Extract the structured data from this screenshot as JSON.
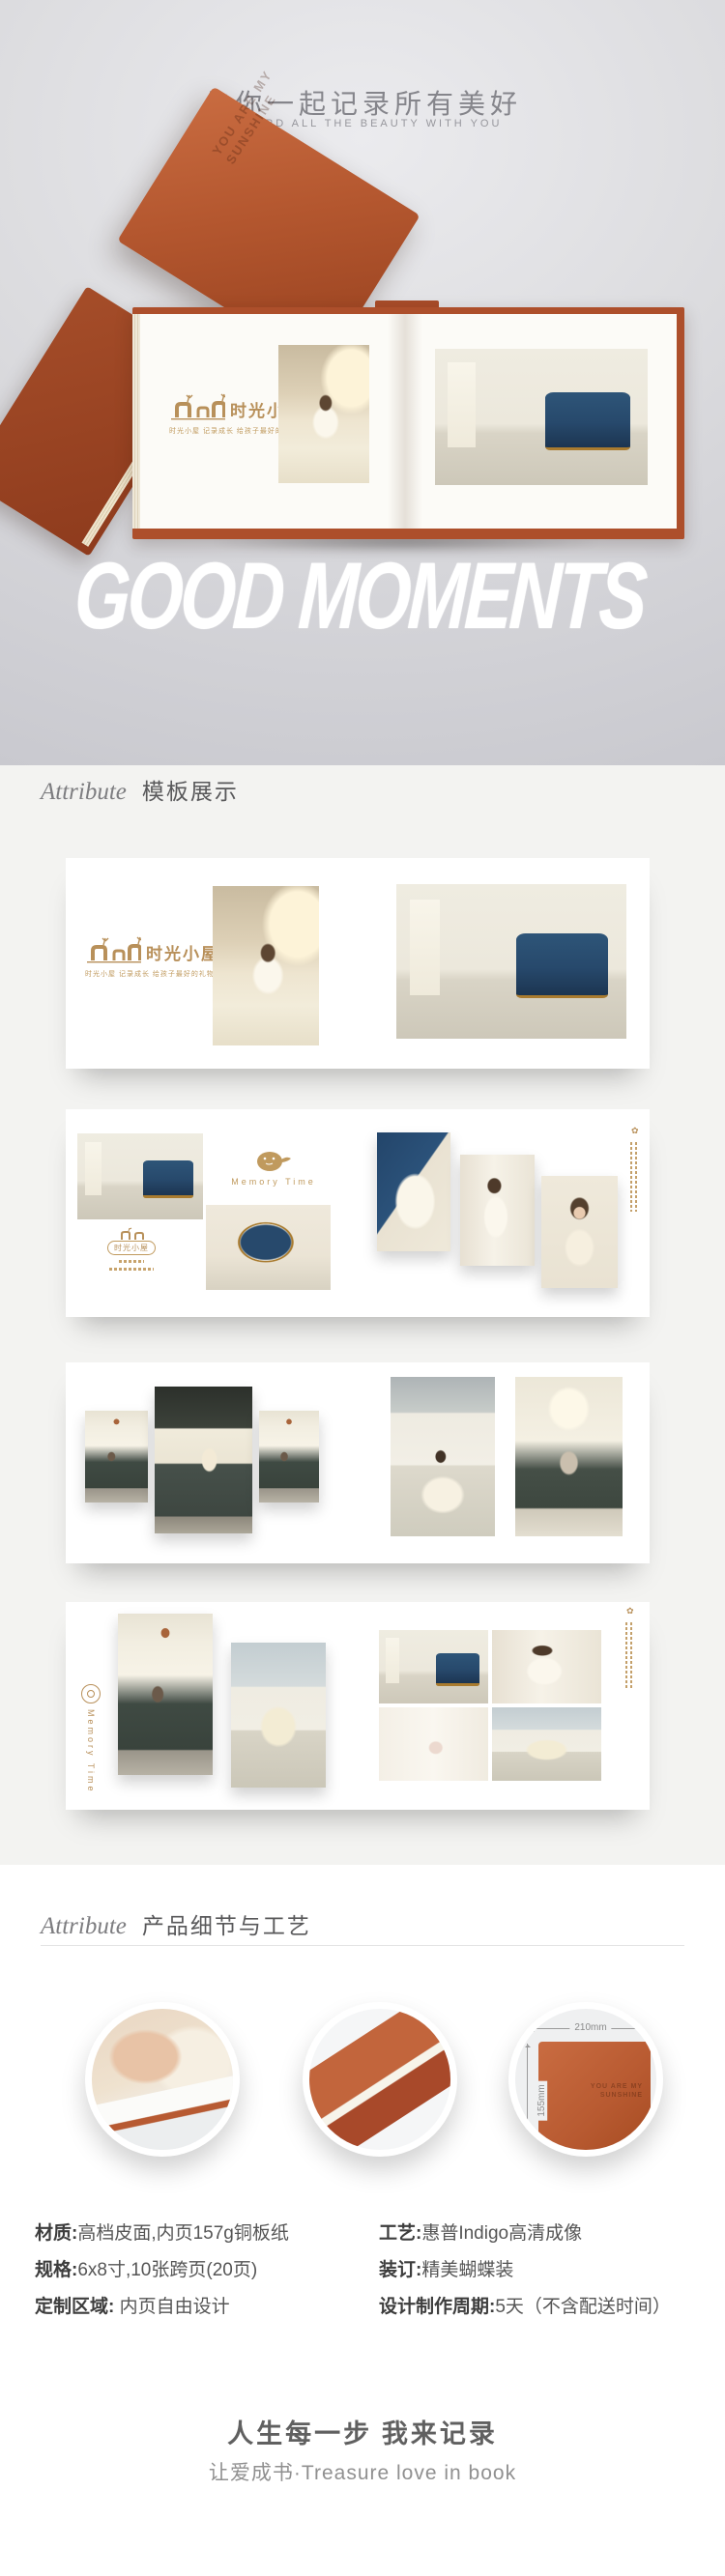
{
  "hero": {
    "title": "与你一起记录所有美好",
    "subtitle": "RECORD ALL THE BEAUTY WITH YOU",
    "brush_text": "GOOD MOMENTS",
    "cover_emboss_line1": "YOU ARE MY",
    "cover_emboss_line2": "SUNSHINE"
  },
  "brand": {
    "name": "时光小屋",
    "tagline": "时光小屋 记录成长 给孩子最好的礼物",
    "memory_label": "Memory Time"
  },
  "icons": {
    "flower": "✿"
  },
  "template_section": {
    "heading_en": "Attribute",
    "heading_cn": "模板展示"
  },
  "detail_section": {
    "heading_en": "Attribute",
    "heading_cn": "产品细节与工艺",
    "dim_width": "210mm",
    "dim_height": "155mm"
  },
  "specs": {
    "left": [
      {
        "label": "材质:",
        "value": "高档皮面,内页157g铜板纸"
      },
      {
        "label": "规格:",
        "value": "6x8寸,10张跨页(20页)"
      },
      {
        "label": "定制区域:",
        "value": "内页自由设计"
      }
    ],
    "right": [
      {
        "label": "工艺:",
        "value": "惠普Indigo高清成像"
      },
      {
        "label": "装订:",
        "value": "精美蝴蝶装"
      },
      {
        "label": "设计制作周期:",
        "value": "5天（不含配送时间）"
      }
    ]
  },
  "footer": {
    "title": "人生每一步 我来记录",
    "subtitle": "让爱成书·Treasure love in book"
  },
  "colors": {
    "leather": "#b35432",
    "gold": "#b8905a",
    "navy": "#27496c",
    "section_bg": "#f3f3f1"
  }
}
